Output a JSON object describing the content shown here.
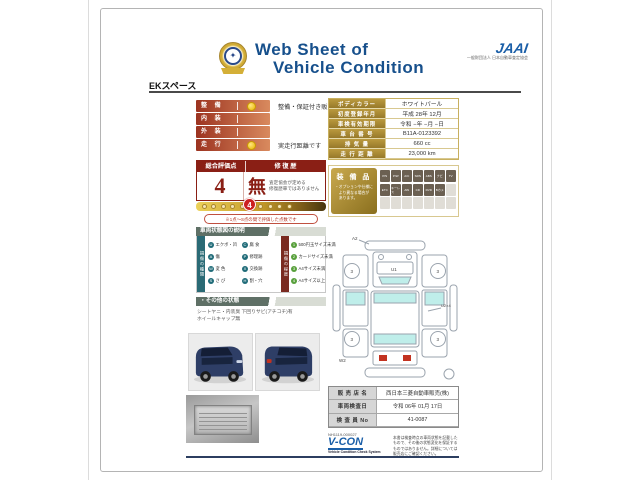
{
  "colors": {
    "header_blue": "#17508c",
    "maroon": "#8a1f15",
    "gold": "#a8872e",
    "teal": "#2a6a75",
    "green": "#58a03c",
    "vcon_blue": "#1b5fa8"
  },
  "header": {
    "title_line1": "Web Sheet of",
    "title_line2": "Vehicle Condition",
    "jaai": "JAAI",
    "jaai_sub": "一般財団法人 日本自動車査定協会",
    "model": "EKスペース"
  },
  "condition": {
    "rows": [
      {
        "label": "整 備",
        "value": "整備・保証付き販売です"
      },
      {
        "label": "内 装",
        "value": ""
      },
      {
        "label": "外 装",
        "value": ""
      },
      {
        "label": "走 行",
        "value": "実走行距離です"
      }
    ]
  },
  "evaluation": {
    "score_header": "総合評価点",
    "repair_header": "修 復 歴",
    "score": "4",
    "repair": "無",
    "repair_note_line1": "査定協会が定める",
    "repair_note_line2": "修復歴車ではありません",
    "marker": "4",
    "note": "※1点〜S点の間で評価した点数です"
  },
  "vehicle_info": {
    "rows": [
      {
        "label": "ボディカラー",
        "value": "ホワイトパール"
      },
      {
        "label": "初度登録年月",
        "value": "平成 28年 12月"
      },
      {
        "label": "車検有効期限",
        "value": "令和 −年 −月 −日"
      },
      {
        "label": "車 台 番 号",
        "value": "B11A-0123392"
      },
      {
        "label": "排 気 量",
        "value": "660 cc"
      },
      {
        "label": "走 行 距 離",
        "value": "23,000 km"
      }
    ]
  },
  "equipment": {
    "title": "装 備 品",
    "notes": [
      "・オプションや仕様に",
      "　より異なる場合が",
      "　あります。"
    ],
    "row1": [
      "P/S",
      "P/W",
      "A/C",
      "SRS",
      "ABS",
      "ナビ",
      "TV"
    ],
    "row2": [
      "ETC",
      "キーレス",
      "AW",
      "CD",
      "DVD",
      "Bカメ"
    ]
  },
  "legend": {
    "header": "車両状態図の説明",
    "type_header": "損傷の種類",
    "degree_header": "損傷の程度",
    "types": [
      {
        "mark": "U",
        "text": "エクボ・凹"
      },
      {
        "mark": "A",
        "text": "傷"
      },
      {
        "mark": "W",
        "text": "変 色"
      },
      {
        "mark": "S",
        "text": "さ び"
      },
      {
        "mark": "C",
        "text": "腐 食"
      },
      {
        "mark": "P",
        "text": "修理跡"
      },
      {
        "mark": "X",
        "text": "交換跡"
      },
      {
        "mark": "H",
        "text": "割・穴"
      }
    ],
    "degrees": [
      {
        "mark": "1",
        "text": "500円玉サイズ未満"
      },
      {
        "mark": "2",
        "text": "カードサイズ未満"
      },
      {
        "mark": "3",
        "text": "A4サイズ未満"
      },
      {
        "mark": "4",
        "text": "A4サイズ以上"
      }
    ]
  },
  "other": {
    "header": "・その他の状態",
    "line1": "シートヤニ・内装臭 下回りサビ(アチコチ)有",
    "line2": "ホイールキャップ無"
  },
  "diagram": {
    "label_front": "A2",
    "label_hood": "U1",
    "label_side": "U2×4",
    "label_rear": "W2",
    "wheel": "3"
  },
  "dealer": {
    "rows": [
      {
        "label": "販 売 店 名",
        "value": "西日本三菱自動車販売(株)"
      },
      {
        "label": "車両検査日",
        "value": "令和 06年 01月 17日"
      },
      {
        "label": "検 査 員 No",
        "value": "41-0087"
      }
    ]
  },
  "footer": {
    "code": "NH1119-000027",
    "vcon": "V-CON",
    "vcon_sub": "Vehicle Condition Check System",
    "disclaimer": [
      "本書は検査時点の車両状態を記載した",
      "もので、その後の状態変化を保証する",
      "ものではありません。詳細については",
      "販売店にご確認ください。"
    ]
  }
}
